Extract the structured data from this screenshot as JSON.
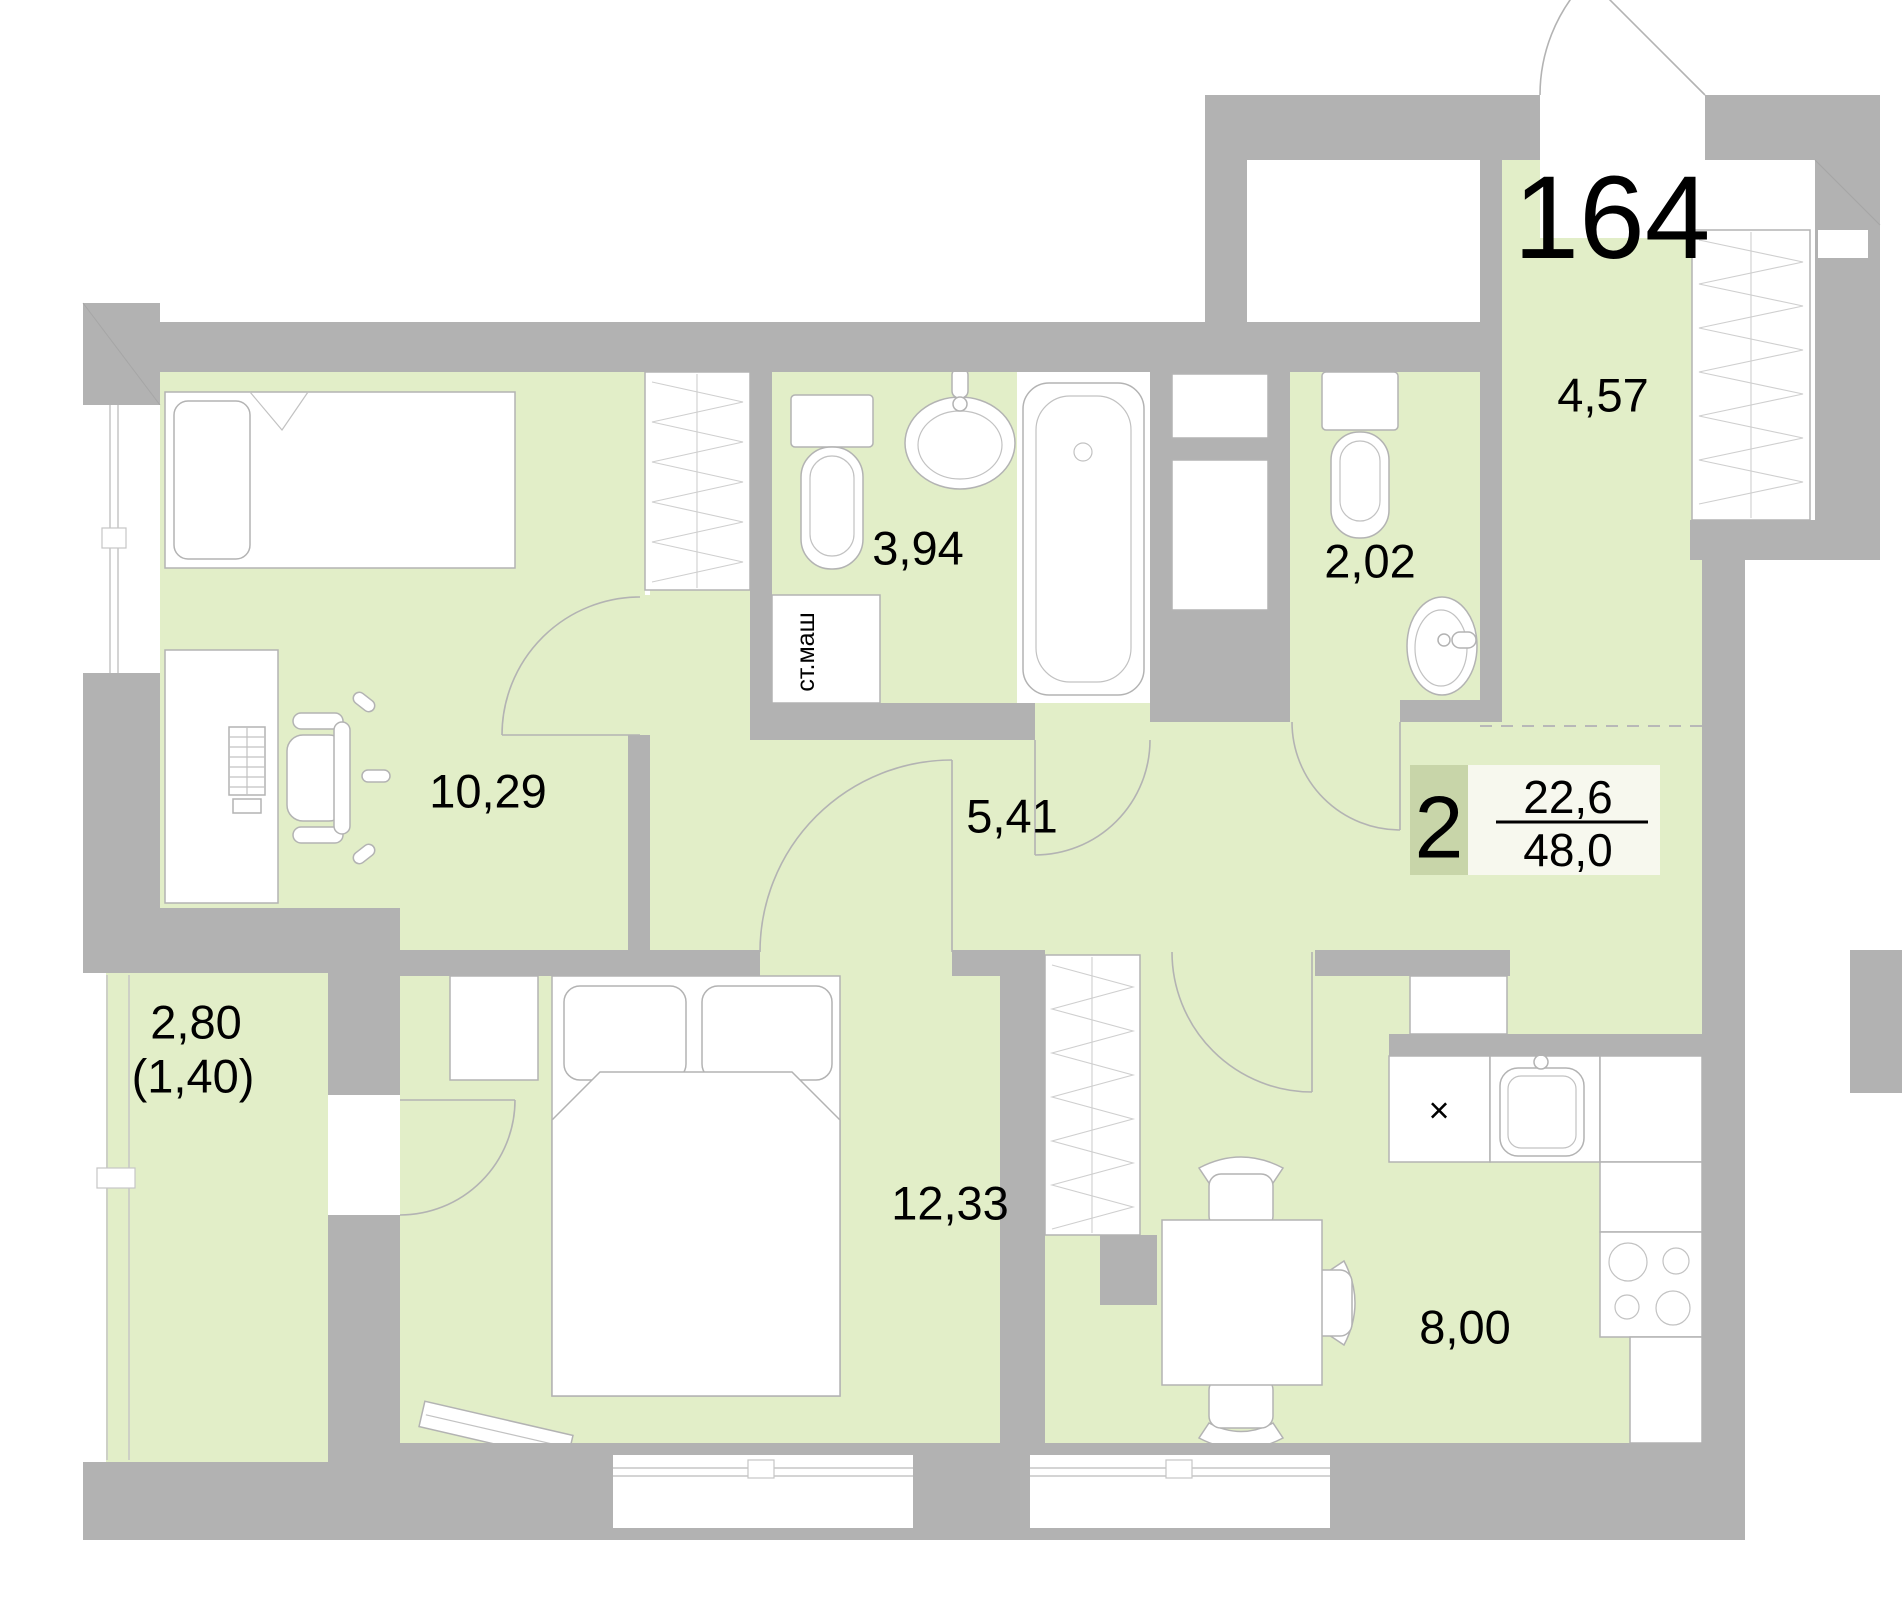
{
  "floor_plan": {
    "apartment_number": "164",
    "badge": {
      "room_count": "2",
      "living_area": "22,6",
      "total_area": "48,0"
    },
    "rooms": [
      {
        "name": "living-room",
        "area": "10,29"
      },
      {
        "name": "bathroom",
        "area": "3,94"
      },
      {
        "name": "wc",
        "area": "2,02"
      },
      {
        "name": "hallway",
        "area": "4,57"
      },
      {
        "name": "corridor",
        "area": "5,41"
      },
      {
        "name": "bedroom",
        "area": "12,33"
      },
      {
        "name": "kitchen",
        "area": "8,00"
      },
      {
        "name": "balcony",
        "area": "2,80",
        "area_reduced": "(1,40)"
      }
    ],
    "labels": {
      "washing_machine": "ст.маш",
      "counter_mark": "×"
    },
    "colors": {
      "wall": "#b2b2b2",
      "floor": "#e2eec8",
      "badge_room_count_bg": "#c8d5a9",
      "badge_values_bg": "#f7f8ee"
    }
  }
}
